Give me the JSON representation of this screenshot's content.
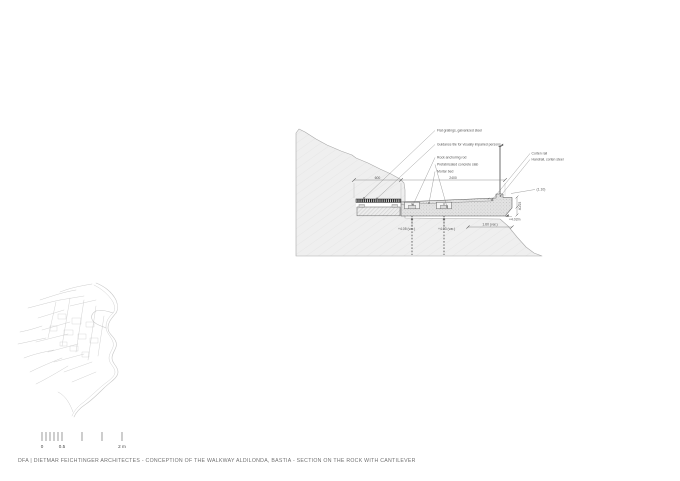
{
  "page": {
    "background": "#ffffff"
  },
  "colors": {
    "drawing_line": "#5f5f5f",
    "rock_fill": "#efefef",
    "concrete_fill": "#e2e2e2",
    "grating_fill": "#1f1f1f",
    "map_line": "#c8c8c8",
    "annotation_text": "#555555",
    "caption_text": "#707070"
  },
  "section": {
    "annotations_left": [
      {
        "label": "Flat gratings, galvanized steel"
      },
      {
        "label": "Guidance tile for visually impaired persons"
      },
      {
        "label": "Rock anchoring rod"
      },
      {
        "label": "Prefabricated concrete slab"
      },
      {
        "label": "Mortar bed"
      }
    ],
    "annotations_right": [
      {
        "label": "Corten rail"
      },
      {
        "label": "Handrail, corten steel"
      }
    ],
    "dimensions": {
      "top_left": "600",
      "top_right": "2400",
      "railing_height": "(1.10)",
      "cantilever_length": "1.60 (var.)",
      "slab_edge": "40/25"
    },
    "levels": {
      "anchor_left": "+4.05 (var.)",
      "anchor_mid": "+4.03 (var.)",
      "slab_bottom": "+4.02m"
    }
  },
  "scale_bar": {
    "tick_labels": [
      "0",
      "0.5",
      "2 m"
    ]
  },
  "footer": {
    "caption": "DFA  |   DIETMAR FEICHTINGER ARCHITECTES - CONCEPTION OF THE WALKWAY ALDILONDA, BASTIA - SECTION ON THE ROCK WITH CANTILEVER"
  }
}
